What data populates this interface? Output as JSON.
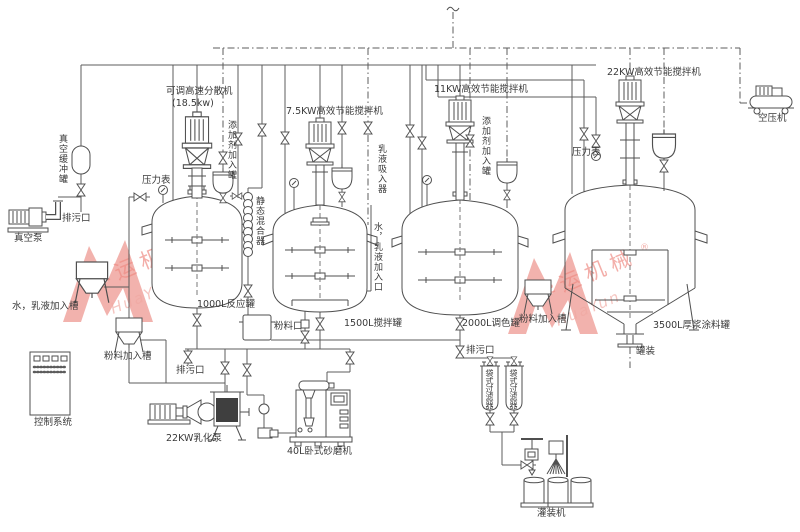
{
  "watermark": {
    "cn": "华运机械",
    "en": "HuaYun",
    "reg": "®"
  },
  "machines": {
    "disperser": "可调高速分散机",
    "disperser_power": "(18.5kw)",
    "mixer_7_5kw": "7.5KW高效节能搅拌机",
    "mixer_11kw": "11KW高效节能搅拌机",
    "mixer_22kw": "22KW高效节能搅拌机",
    "air_compressor": "空压机",
    "vacuum_pump": "真空泵",
    "emulsify_pump": "22KW乳化泵",
    "sand_mill": "40L卧式砂磨机",
    "filling_machine": "灌装机",
    "control_system": "控制系统"
  },
  "tanks": {
    "reaction_1000l": "1000L反应罐",
    "mixing_1500l": "1500L搅拌罐",
    "tinting_2000l": "2000L调色罐",
    "thick_paste_3500l": "3500L厚浆涂料罐",
    "vacuum_buffer": "真空缓冲罐",
    "additive_1": "添加剂加入罐",
    "additive_2": "添加剂加入罐",
    "water_emulsion_hopper": "水，乳液加入槽",
    "powder_hopper_left": "粉料加入槽",
    "powder_hopper_right": "粉料加入槽",
    "bag_filter_1": "袋式过滤器",
    "bag_filter_2": "袋式过滤器"
  },
  "ports": {
    "drain_left": "排污口",
    "drain_mid": "排污口",
    "drain_right": "排污口",
    "pressure_gauge_left": "压力表",
    "pressure_gauge_right": "压力表",
    "static_mixer": "静态混合器",
    "emulsion_suction": "乳液吸入器",
    "water_emulsion_inlet": "水，乳液加入口",
    "powder_inlet": "粉料口",
    "canning": "罐装"
  }
}
